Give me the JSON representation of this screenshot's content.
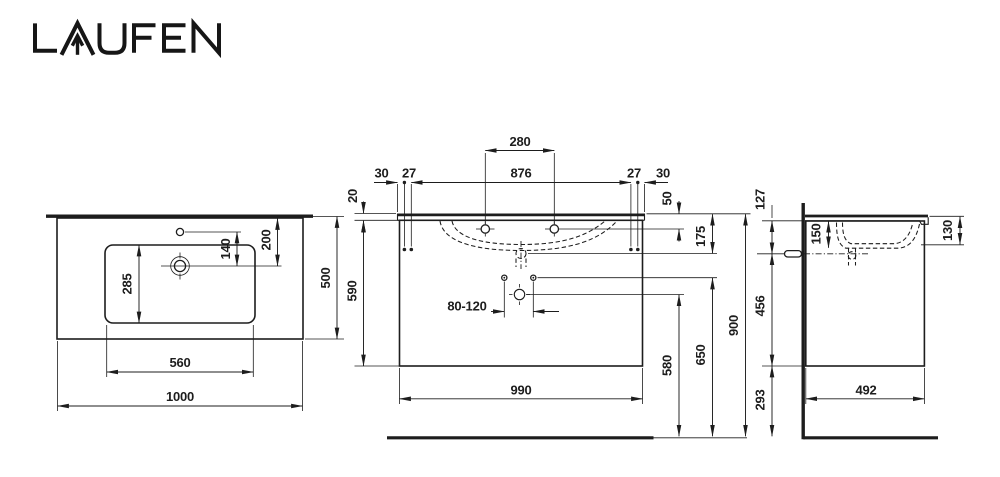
{
  "brand": {
    "logo_text": "LAUFEN"
  },
  "colors": {
    "line": "#1d1d1d",
    "background": "#ffffff"
  },
  "drawing": {
    "type": "technical-dimension-drawing",
    "subject": "washbasin with vanity unit, three orthographic views (plan, front, side)"
  },
  "dimensions": {
    "plan": {
      "overall_width": "1000",
      "basin_width": "560",
      "overall_depth": "500",
      "basin_depth": "285",
      "hole_to_drain": "140",
      "edge_to_drain": "200"
    },
    "front": {
      "tap_hole_spacing": "280",
      "fixing_hole_spacing": "876",
      "edge_to_fixing": "30",
      "fixing_gap": "27",
      "top_thickness": "20",
      "top_to_tap_hole": "50",
      "top_to_overflow": "175",
      "cabinet_height": "590",
      "cabinet_width": "990",
      "trap_outlet_height": "580",
      "supply_height": "650",
      "overall_height": "900",
      "supply_spacing": "80-120"
    },
    "side": {
      "top_to_connection": "127",
      "top_to_drain": "150",
      "front_edge_height": "130",
      "connection_to_bottom": "456",
      "bottom_to_floor": "293",
      "cabinet_depth": "492"
    }
  }
}
